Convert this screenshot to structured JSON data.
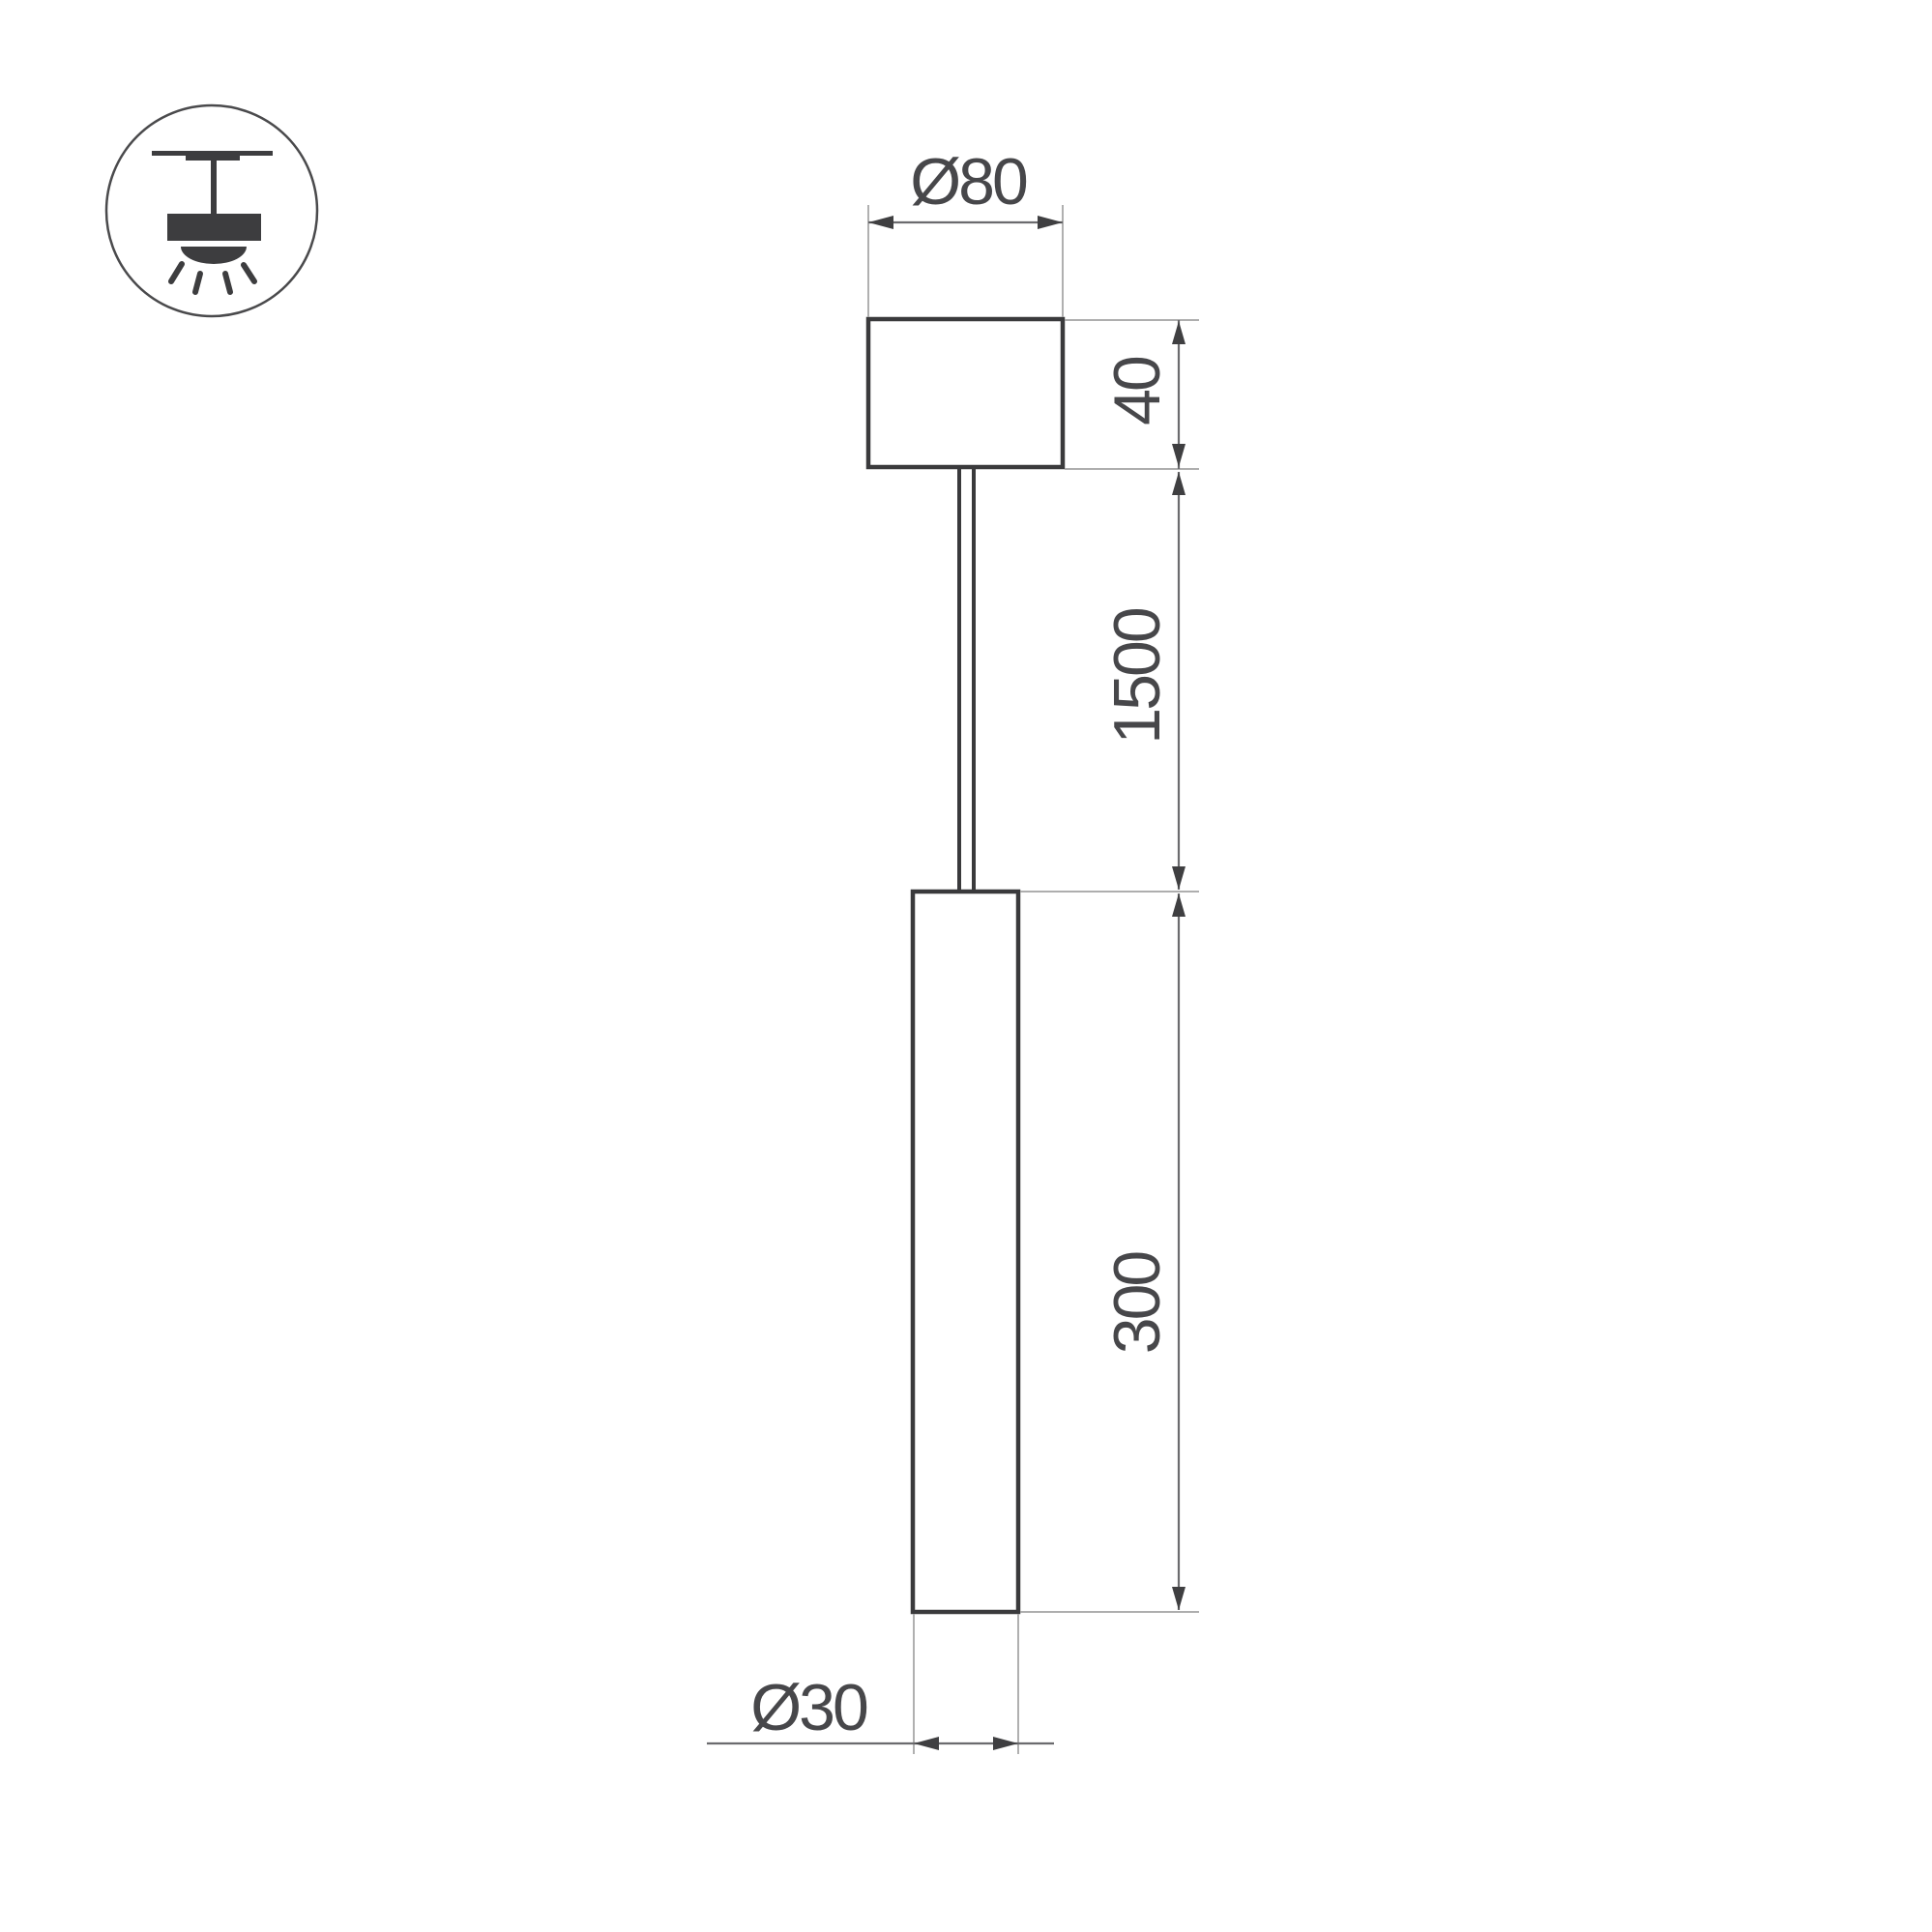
{
  "page": {
    "background": "#ffffff"
  },
  "drawing": {
    "kind": "pendant-luminaire-dimension-drawing",
    "labels": {
      "canopy_diameter": "Ø80",
      "canopy_height": "40",
      "suspension_length": "1500",
      "tube_length": "300",
      "tube_diameter": "Ø30"
    },
    "colors": {
      "shape_stroke": "#3a3a3c",
      "dimension_line": "#6b6b6e",
      "extension_line": "#a3a3a3",
      "text": "#47474a",
      "icon_fill": "#3d3d3f",
      "background": "#ffffff"
    },
    "icon": {
      "name": "suspended-ceiling-mount-icon"
    }
  }
}
